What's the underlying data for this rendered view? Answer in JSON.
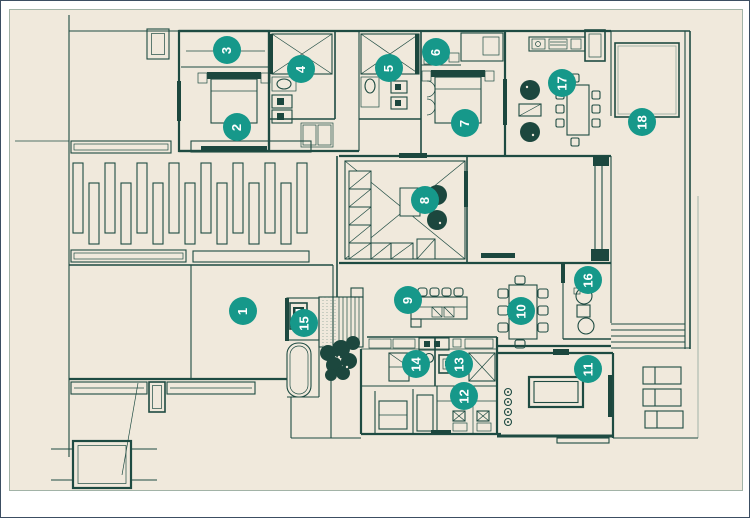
{
  "image": {
    "kind": "architectural-floor-plan",
    "width_px": 750,
    "height_px": 518
  },
  "palette": {
    "line": "#1e4b42",
    "line_light": "#8fa69a",
    "fill_dark": "#1c473e",
    "marker": "#16988a",
    "marker_text": "#ffffff",
    "canvas": "#f0e9dc",
    "page": "#ffffff",
    "frame": "#3c4e62"
  },
  "marker_style": {
    "radius": 14,
    "rotation_deg": -90
  },
  "markers": [
    {
      "label": "1",
      "x": 242,
      "y": 310
    },
    {
      "label": "2",
      "x": 236,
      "y": 126
    },
    {
      "label": "3",
      "x": 226,
      "y": 49
    },
    {
      "label": "4",
      "x": 300,
      "y": 68
    },
    {
      "label": "5",
      "x": 388,
      "y": 67
    },
    {
      "label": "6",
      "x": 435,
      "y": 51
    },
    {
      "label": "7",
      "x": 464,
      "y": 122
    },
    {
      "label": "8",
      "x": 424,
      "y": 199
    },
    {
      "label": "9",
      "x": 407,
      "y": 299
    },
    {
      "label": "10",
      "x": 520,
      "y": 310
    },
    {
      "label": "11",
      "x": 587,
      "y": 368
    },
    {
      "label": "12",
      "x": 463,
      "y": 395
    },
    {
      "label": "13",
      "x": 458,
      "y": 363
    },
    {
      "label": "14",
      "x": 415,
      "y": 363
    },
    {
      "label": "15",
      "x": 303,
      "y": 322
    },
    {
      "label": "16",
      "x": 587,
      "y": 279
    },
    {
      "label": "17",
      "x": 561,
      "y": 82
    },
    {
      "label": "18",
      "x": 641,
      "y": 121
    }
  ]
}
